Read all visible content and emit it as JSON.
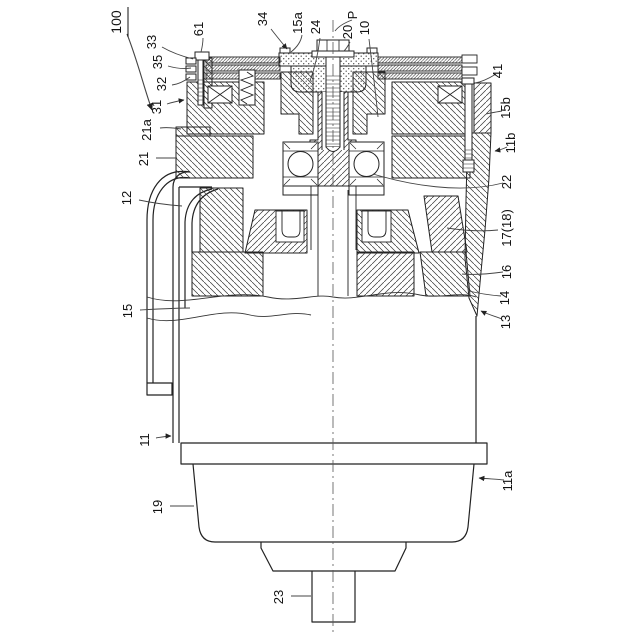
{
  "figure": {
    "type": "patent-cross-section-drawing",
    "background": "#ffffff",
    "line_color": "#222222",
    "leader_color": "#444444",
    "labels": {
      "n100": "100",
      "n61": "61",
      "n33": "33",
      "n35": "35",
      "n32": "32",
      "n34": "34",
      "n15a": "15a",
      "n24": "24",
      "nP": "P",
      "n20": "20",
      "n10": "10",
      "n41": "41",
      "n15b": "15b",
      "n11b": "11b",
      "n22": "22",
      "n17_18": "17(18)",
      "n16": "16",
      "n14": "14",
      "n13": "13",
      "n31": "31",
      "n21a": "21a",
      "n21": "21",
      "n12": "12",
      "n15": "15",
      "n11": "11",
      "n19": "19",
      "n23": "23",
      "n11a": "11a"
    }
  }
}
